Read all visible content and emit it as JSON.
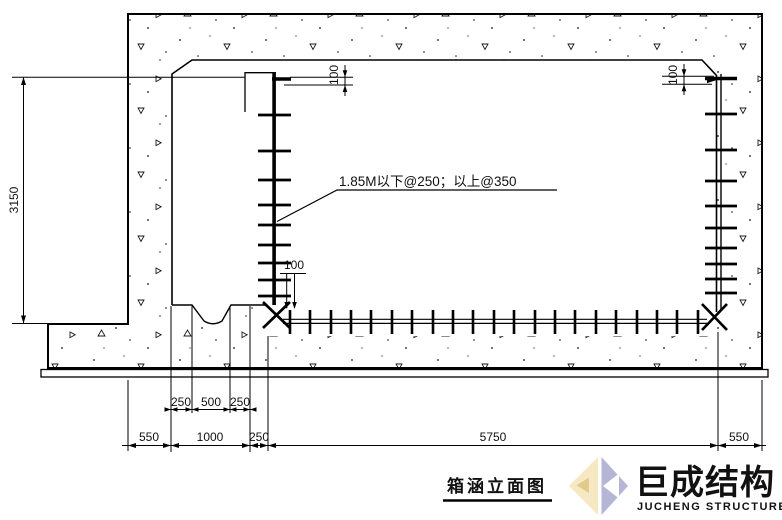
{
  "drawing": {
    "title": "箱涵立面图",
    "annotation": "1.85M以下@250；以上@350",
    "dims": {
      "height_left": "3150",
      "offsets": {
        "top_left": "100",
        "top_right": "100",
        "bottom_corner": "100"
      },
      "gutter_row": [
        "250",
        "500",
        "250"
      ],
      "bottom_row": [
        "550",
        "1000",
        "250",
        "5750",
        "550"
      ]
    }
  },
  "logo": {
    "cn": "巨成结构",
    "en": "JUCHENG STRUCTURE",
    "colors": {
      "lavender": "#b5b6d6",
      "yellow": "#f5e8c2",
      "dark_yellow": "#e2c98c",
      "white": "#ffffff"
    }
  }
}
